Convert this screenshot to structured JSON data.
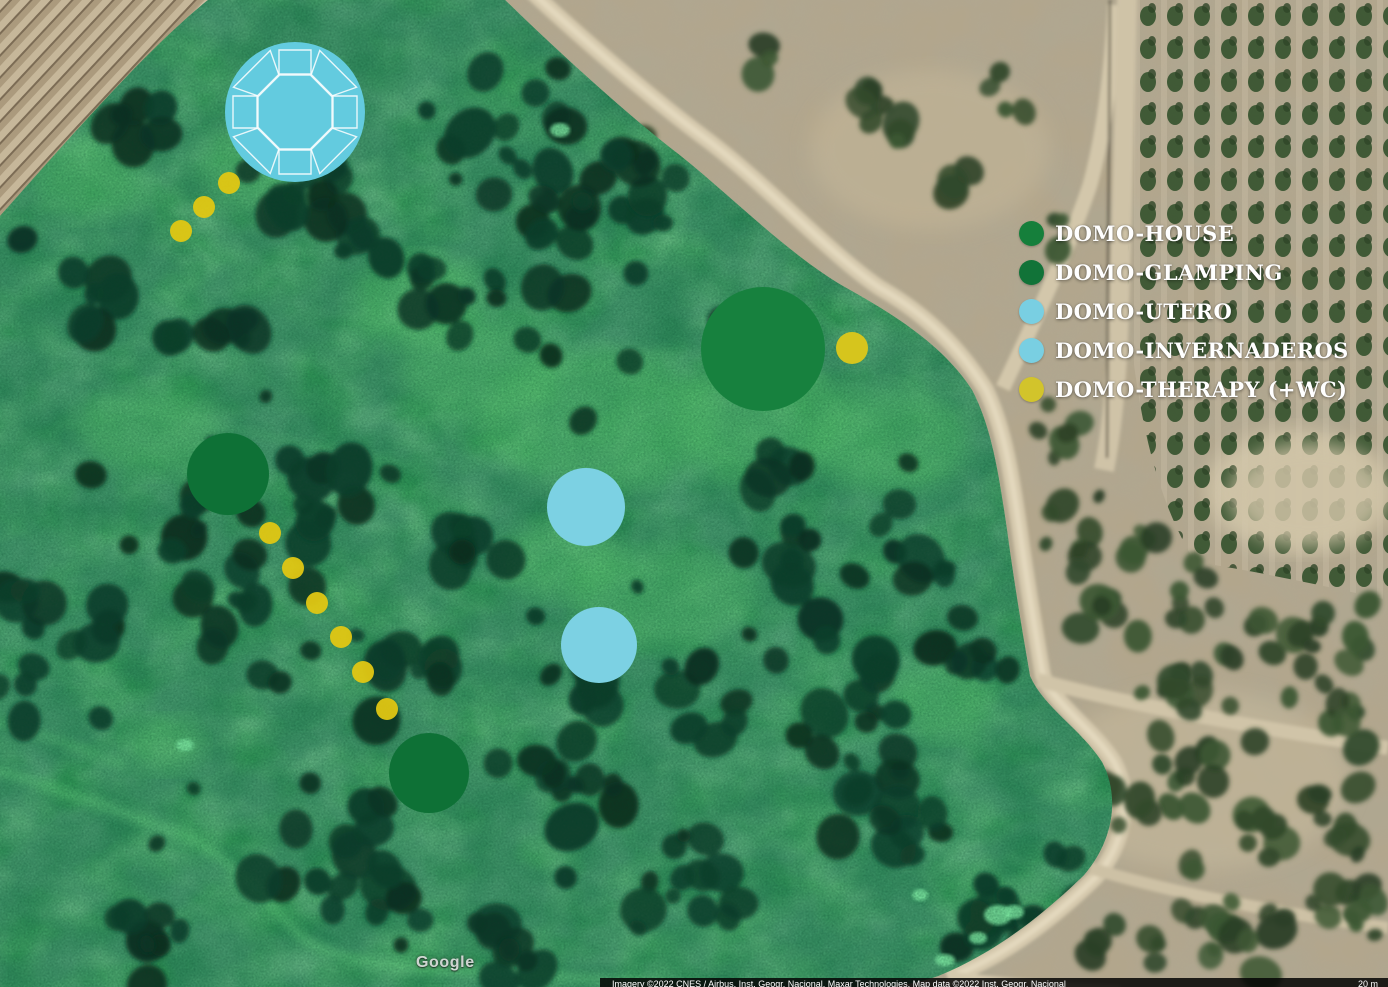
{
  "map": {
    "watermark": "Google",
    "attribution": "Imagery ©2022 CNES / Airbus, Inst. Geogr. Nacional, Maxar Technologies, Map data ©2022 Inst. Geogr. Nacional",
    "scale_label": "20 m",
    "legend": {
      "items": [
        {
          "id": "domo-house",
          "label": "DOMO-HOUSE",
          "color": "#157f3b"
        },
        {
          "id": "domo-glamping",
          "label": "DOMO-GLAMPING",
          "color": "#117338"
        },
        {
          "id": "domo-utero",
          "label": "DOMO-UTERO",
          "color": "#79cfe2"
        },
        {
          "id": "domo-invernaderos",
          "label": "DOMO-INVERNADEROS",
          "color": "#79cfe2"
        },
        {
          "id": "domo-therapy",
          "label": "DOMO-THERAPY (+WC)",
          "color": "#d2c42b"
        }
      ]
    },
    "markers": [
      {
        "id": "domo-utero-plan",
        "legend": "domo-utero",
        "x": 295,
        "y": 112,
        "r": 70,
        "color": "#63cbdf",
        "plan": true
      },
      {
        "id": "domo-house-main",
        "legend": "domo-house",
        "x": 763,
        "y": 349,
        "r": 62,
        "color": "#17813e"
      },
      {
        "id": "domo-glamping-north",
        "legend": "domo-glamping",
        "x": 228,
        "y": 474,
        "r": 41,
        "color": "#0e7136"
      },
      {
        "id": "domo-glamping-south",
        "legend": "domo-glamping",
        "x": 429,
        "y": 773,
        "r": 40,
        "color": "#0e7136"
      },
      {
        "id": "domo-invernadero-north",
        "legend": "domo-invernaderos",
        "x": 586,
        "y": 507,
        "r": 39,
        "color": "#7cd1e3"
      },
      {
        "id": "domo-invernadero-south",
        "legend": "domo-invernaderos",
        "x": 599,
        "y": 645,
        "r": 38,
        "color": "#7cd1e3"
      },
      {
        "id": "domo-therapy-wc",
        "legend": "domo-therapy",
        "x": 852,
        "y": 348,
        "r": 16,
        "color": "#d6c51d"
      }
    ],
    "path_dots": {
      "color": "#e0c713",
      "r": 11,
      "upper_trail": [
        [
          229,
          183
        ],
        [
          204,
          207
        ],
        [
          181,
          231
        ]
      ],
      "lower_trail": [
        [
          270,
          533
        ],
        [
          293,
          568
        ],
        [
          317,
          603
        ],
        [
          341,
          637
        ],
        [
          363,
          672
        ],
        [
          387,
          709
        ]
      ]
    }
  }
}
